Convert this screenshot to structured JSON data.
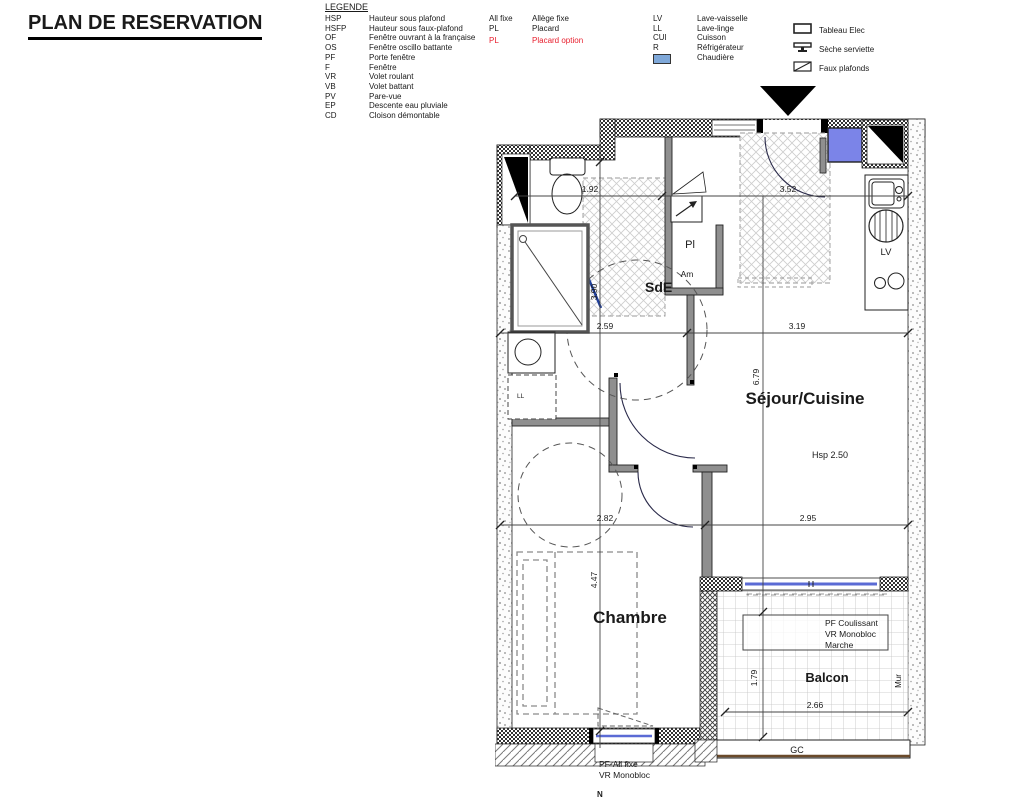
{
  "title": "PLAN DE RESERVATION",
  "legend": {
    "header": "LEGENDE",
    "col1": [
      {
        "abbr": "HSP",
        "label": "Hauteur sous plafond"
      },
      {
        "abbr": "HSFP",
        "label": "Hauteur sous faux-plafond"
      },
      {
        "abbr": "OF",
        "label": "Fenêtre ouvrant à la française"
      },
      {
        "abbr": "OS",
        "label": "Fenêtre oscillo battante"
      },
      {
        "abbr": "PF",
        "label": "Porte fenêtre"
      },
      {
        "abbr": "F",
        "label": "Fenêtre"
      },
      {
        "abbr": "VR",
        "label": "Volet roulant"
      },
      {
        "abbr": "VB",
        "label": "Volet battant"
      },
      {
        "abbr": "PV",
        "label": "Pare-vue"
      },
      {
        "abbr": "EP",
        "label": "Descente eau pluviale"
      },
      {
        "abbr": "CD",
        "label": "Cloison démontable"
      }
    ],
    "col2": [
      {
        "abbr": "All fixe",
        "label": "Allège fixe"
      },
      {
        "abbr": "PL",
        "label": "Placard"
      },
      {
        "abbr": "PL",
        "label": "Placard option"
      }
    ],
    "col3": [
      {
        "abbr": "LV",
        "label": "Lave-vaisselle"
      },
      {
        "abbr": "LL",
        "label": "Lave-linge"
      },
      {
        "abbr": "CUI",
        "label": "Cuisson"
      },
      {
        "abbr": "R",
        "label": "Réfrigérateur"
      },
      {
        "abbr": "",
        "label": "Chaudière"
      }
    ],
    "col4": [
      {
        "label": "Tableau Elec"
      },
      {
        "label": "Sèche serviette"
      },
      {
        "label": "Faux plafonds"
      }
    ]
  },
  "plan": {
    "labels": {
      "sde": "SdE",
      "sejour": "Séjour/Cuisine",
      "chambre": "Chambre",
      "balcon": "Balcon",
      "pl": "Pl",
      "am": "Am",
      "ll": "LL",
      "lv": "LV",
      "mur": "Mur",
      "gc": "GC",
      "hsp": "Hsp 2.50",
      "north": "N"
    },
    "annotations": {
      "pf_coulissant": "PF Coulissant",
      "vr_monobloc": "VR Monobloc",
      "marche": "Marche",
      "pf_all_fixe": "PF-All fixe",
      "vr_monobloc_2": "VR Monobloc"
    },
    "dimensions": {
      "wc_width": "1.92",
      "entry_width": "3.52",
      "sde_depth": "3.90",
      "sde_width": "2.59",
      "sejour_width": "3.19",
      "sejour_depth": "6.79",
      "chambre_width": "2.82",
      "sejour_width_2": "2.95",
      "chambre_depth": "4.47",
      "balcon_depth": "1.79",
      "balcon_width": "2.66"
    }
  },
  "colors": {
    "boiler_blue": "#7b84e8",
    "legend_blue": "#7fa8d9",
    "option_red": "#e81e2d",
    "glazing_blue": "#5b6bd5"
  }
}
